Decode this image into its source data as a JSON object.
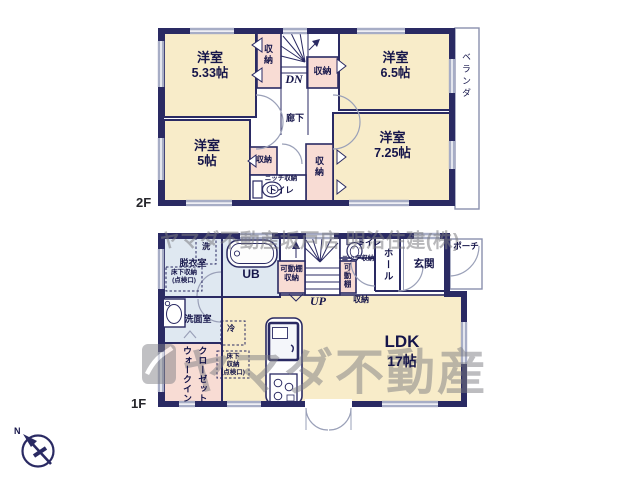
{
  "meta": {
    "floor2": "2F",
    "floor1": "1F",
    "compass_n": "N"
  },
  "watermark": {
    "top": "ヤマダ不動産坂戸店 明治住建(株)",
    "main": "ヤマダ不動産"
  },
  "f2": {
    "room_a": {
      "name": "洋室",
      "size": "5.33帖"
    },
    "room_b": {
      "name": "洋室",
      "size": "6.5帖"
    },
    "room_c": {
      "name": "洋室",
      "size": "5帖"
    },
    "room_d": {
      "name": "洋室",
      "size": "7.25帖"
    },
    "closet_a": "収納",
    "closet_b": "収納",
    "closet_c": "収納",
    "closet_d": "収納",
    "dn": "DN",
    "corridor": "廊下",
    "niche": "ニッチ収納",
    "toilet": "トイレ",
    "veranda": "ベランダ"
  },
  "f1": {
    "ldk": {
      "name": "LDK",
      "size": "17帖"
    },
    "dressing": "脱衣室",
    "washer": "洗",
    "underfloor_a": {
      "l1": "床下収納",
      "l2": "(点検口)"
    },
    "ub": "UB",
    "shelf_a": {
      "l1": "可動棚",
      "l2": "収納"
    },
    "up": "UP",
    "niche": "ニッチ収納",
    "toilet": "トイレ",
    "shelf_b": "可動棚",
    "closet": "収納",
    "hall": "ホール",
    "entrance": "玄関",
    "porch": "ポーチ",
    "washroom": "洗面室",
    "wic": {
      "l1": "ウォークイン",
      "l2": "クローゼット"
    },
    "fridge": "冷",
    "underfloor_b": {
      "l1": "床下",
      "l2": "収納",
      "l3": "(点検口)"
    }
  }
}
